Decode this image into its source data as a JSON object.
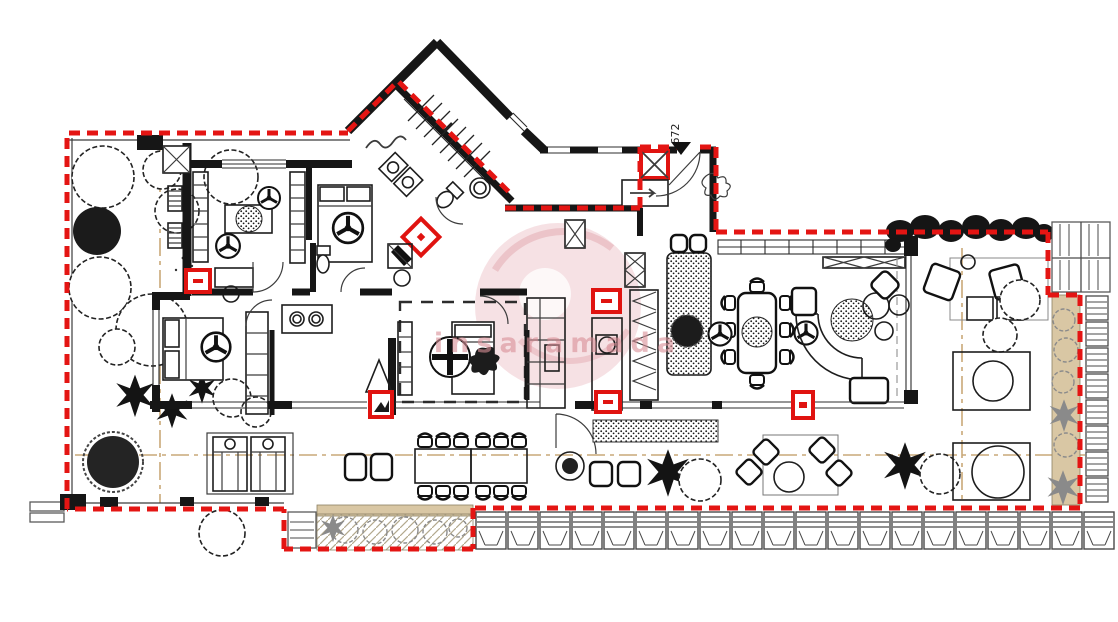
{
  "drawing": {
    "kind": "architectural-floor-plan",
    "labels": {
      "entrance_door_number": "672",
      "watermark_text": "insaramada"
    },
    "colors": {
      "paper": "#ffffff",
      "wall_black": "#161616",
      "boundary_red": "#e41513",
      "marker_red": "#e01310",
      "tan": "#d9c7a4",
      "louvre_gray": "#5a5a5a",
      "plant_gray": "#8b8b8b",
      "watermark_pink": "#eec9cd",
      "watermark_text": "#d98f97"
    },
    "legend_semantics": {
      "red_dashed_line": "unit-boundary",
      "red_boxes": "heating-convector-markers",
      "tan_strips": "planter-beds",
      "hatched_modules": "perimeter-louvre-planters"
    }
  }
}
